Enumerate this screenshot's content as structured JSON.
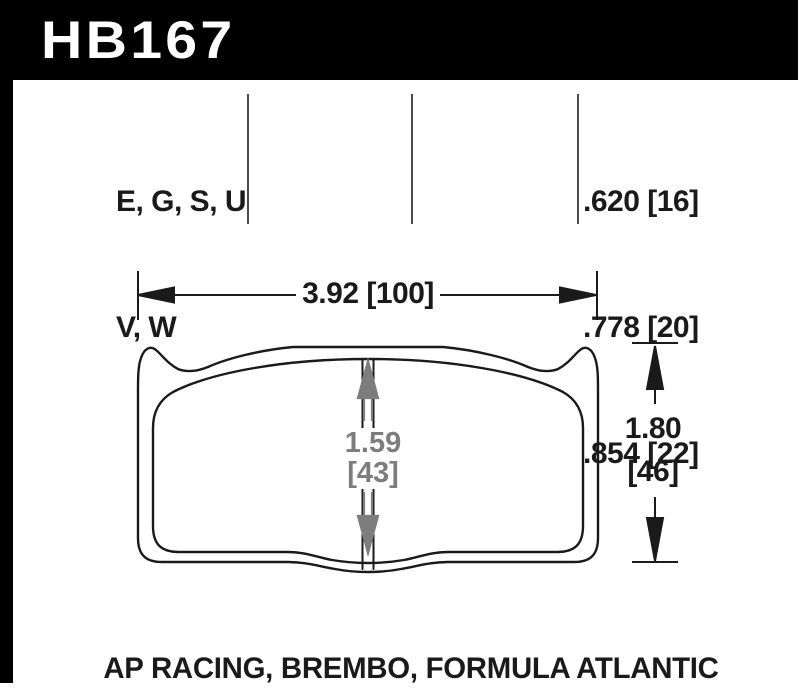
{
  "part": {
    "number": "HB167"
  },
  "compounds": {
    "line1": "E, G, S, U",
    "line2": "V, W"
  },
  "pad_thicknesses": {
    "values": [
      ".620 [16]",
      ".778 [20]",
      ".854 [22]"
    ]
  },
  "dimensions": {
    "overall_width": "3.92 [100]",
    "overall_height_in": "1.80",
    "overall_height_mm": "[46]",
    "center_height_in": "1.59",
    "center_height_mm": "[43]"
  },
  "applications": {
    "caption": "AP RACING, BREMBO, FORMULA ATLANTIC"
  },
  "colors": {
    "header_bg": "#000000",
    "header_fg": "#ffffff",
    "line": "#1a1a1a",
    "dim_gray": "#7d7d7d",
    "divider": "#4d4d4d",
    "page_bg": "#ffffff"
  }
}
